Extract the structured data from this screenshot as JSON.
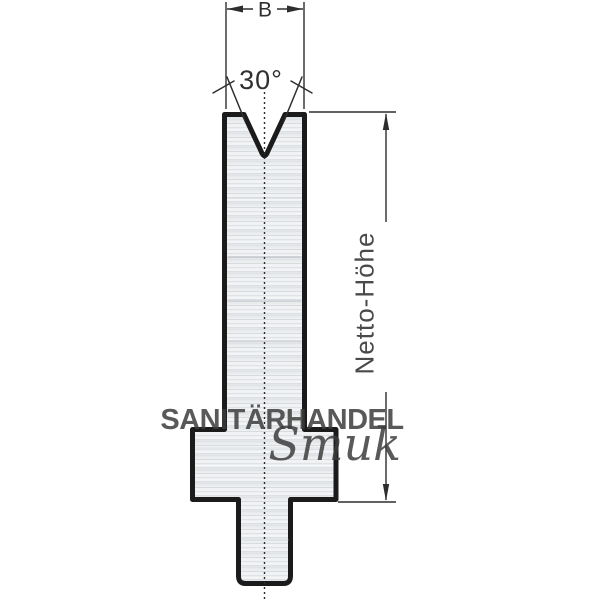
{
  "drawing": {
    "description": "Press brake V-die cross-section technical drawing",
    "labels": {
      "width": "B",
      "angle": "30°",
      "height": "Netto-Höhe"
    },
    "colors": {
      "outline": "#1b1b1b",
      "dimension": "#2e2e2e",
      "dimension_text": "#3d3d3d",
      "metal_base": "#eff1f2",
      "watermark": "#56a4d8"
    }
  },
  "watermark": {
    "line1": "SANITÄRHANDEL",
    "line2": "Smuk"
  }
}
